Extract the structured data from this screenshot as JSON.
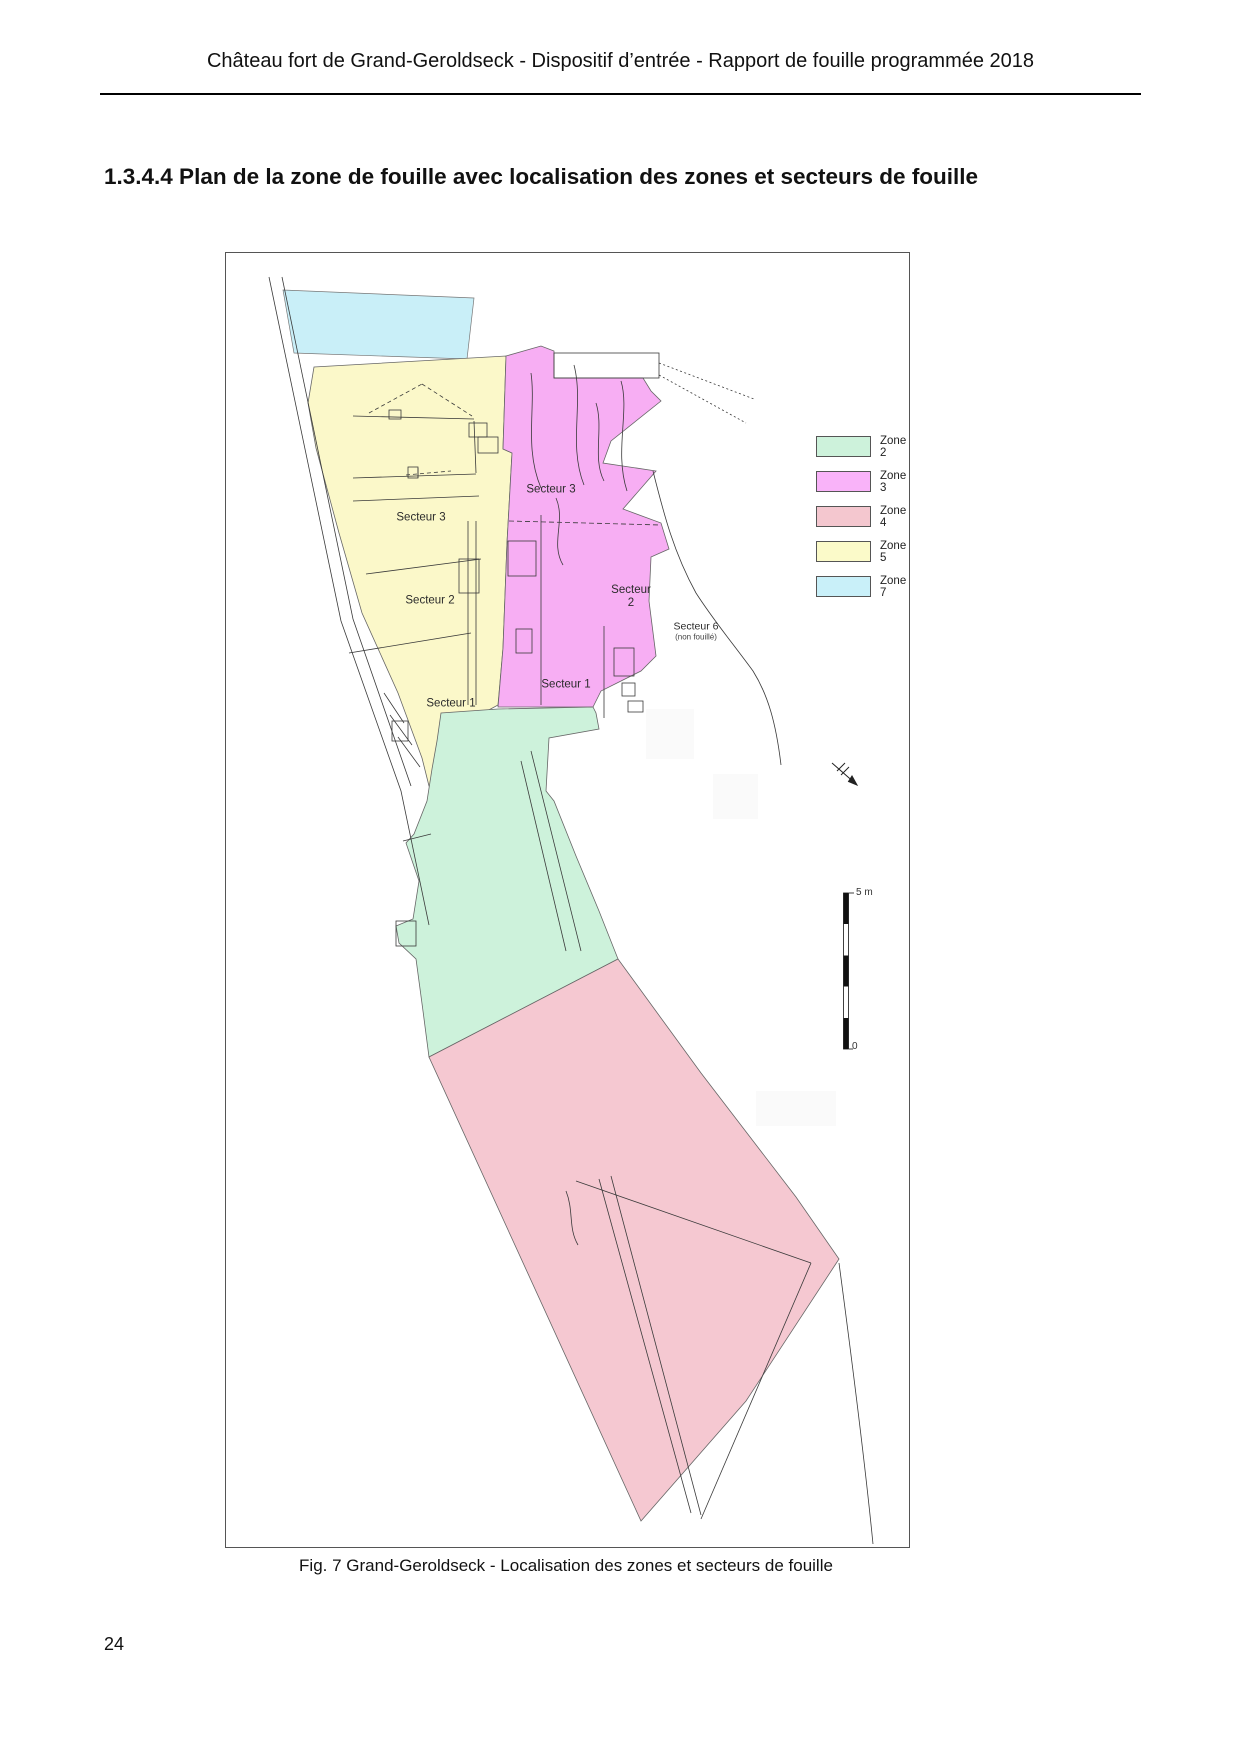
{
  "page": {
    "header": "Château fort de Grand-Geroldseck - Dispositif d’entrée - Rapport de fouille programmée 2018",
    "section_title": "1.3.4.4 Plan de la zone de fouille avec localisation des zones et secteurs de fouille",
    "caption": "Fig. 7 Grand-Geroldseck - Localisation des zones et secteurs de fouille",
    "page_number": "24"
  },
  "figure": {
    "zones": {
      "z2": {
        "name": "Zone 2",
        "color": "#cdf2db"
      },
      "z3": {
        "name": "Zone 3",
        "color": "#f7aef3"
      },
      "z4": {
        "name": "Zone 4",
        "color": "#f5c8d1"
      },
      "z5": {
        "name": "Zone 5",
        "color": "#fbf8c9"
      },
      "z7": {
        "name": "Zone 7",
        "color": "#c9eff8"
      }
    },
    "legend": [
      {
        "label": "Zone 2",
        "color": "#cdf2db"
      },
      {
        "label": "Zone 3",
        "color": "#f9b3f9"
      },
      {
        "label": "Zone 4",
        "color": "#f4c7cf"
      },
      {
        "label": "Zone 5",
        "color": "#fbfac9"
      },
      {
        "label": "Zone 7",
        "color": "#c9f0f9"
      }
    ],
    "labels": {
      "z3_secteur3": "Secteur 3",
      "z5_secteur3": "Secteur 3",
      "z5_secteur2": "Secteur 2",
      "z3_secteur2_line1": "Secteur",
      "z3_secteur2_line2": "2",
      "z3_secteur1": "Secteur 1",
      "z5_secteur1": "Secteur 1",
      "secteur6": "Secteur 6",
      "secteur6_note": "(non fouillé)"
    },
    "scale": {
      "top": "5 m",
      "bottom": "0"
    }
  }
}
